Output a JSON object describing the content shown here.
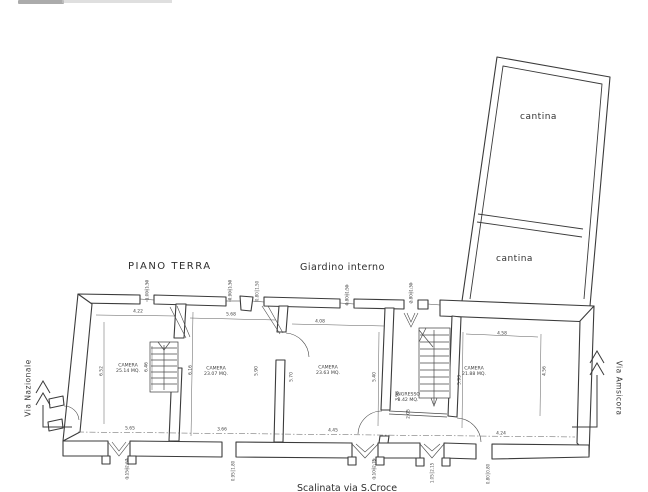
{
  "page": {
    "title": "PIANO TERRA",
    "garden_label": "Giardino interno",
    "left_street": "Via Nazionale",
    "right_street": "Via Amsicora",
    "bottom_street": "Scalinata via S.Croce"
  },
  "annex": {
    "rooms": [
      {
        "label": "cantina"
      },
      {
        "label": "cantina"
      }
    ]
  },
  "rooms": [
    {
      "name": "CAMERA",
      "area": "25.14 MQ."
    },
    {
      "name": "CAMERA",
      "area": "23.07 MQ."
    },
    {
      "name": "CAMERA",
      "area": "23.63 MQ."
    },
    {
      "name": "INGRESSO",
      "area": "8.42 MQ."
    },
    {
      "name": "CAMERA",
      "area": "21.88 MQ."
    }
  ],
  "dimensions": [
    {
      "v": "4.22",
      "x": 138,
      "y": 311,
      "r": 0
    },
    {
      "v": "5.68",
      "x": 231,
      "y": 314,
      "r": 0
    },
    {
      "v": "4.08",
      "x": 320,
      "y": 321,
      "r": 0
    },
    {
      "v": "4.58",
      "x": 502,
      "y": 333,
      "r": 0
    },
    {
      "v": "5.65",
      "x": 130,
      "y": 428,
      "r": 0
    },
    {
      "v": "3.66",
      "x": 222,
      "y": 429,
      "r": 0
    },
    {
      "v": "4.45",
      "x": 333,
      "y": 430,
      "r": 0
    },
    {
      "v": "4.24",
      "x": 501,
      "y": 433,
      "r": 0
    },
    {
      "v": "6.52",
      "x": 101,
      "y": 371,
      "r": -90
    },
    {
      "v": "6.46",
      "x": 146,
      "y": 367,
      "r": -90
    },
    {
      "v": "6.16",
      "x": 190,
      "y": 370,
      "r": -90
    },
    {
      "v": "5.90",
      "x": 256,
      "y": 371,
      "r": -90
    },
    {
      "v": "5.70",
      "x": 291,
      "y": 377,
      "r": -90
    },
    {
      "v": "5.40",
      "x": 374,
      "y": 377,
      "r": -90
    },
    {
      "v": "3.98",
      "x": 397,
      "y": 396,
      "r": -90
    },
    {
      "v": "2.05",
      "x": 408,
      "y": 414,
      "r": -90
    },
    {
      "v": "5.93",
      "x": 459,
      "y": 380,
      "r": -90
    },
    {
      "v": "4.56",
      "x": 544,
      "y": 371,
      "r": -90
    }
  ],
  "window_dims": [
    {
      "a": "1.00",
      "b": "1.50",
      "x": 147,
      "y": 290
    },
    {
      "a": "0.90",
      "b": "1.50",
      "x": 230,
      "y": 290
    },
    {
      "a": "0.80",
      "b": "1.50",
      "x": 257,
      "y": 291
    },
    {
      "a": "0.80",
      "b": "1.50",
      "x": 347,
      "y": 295
    },
    {
      "a": "2.80",
      "b": "1.30",
      "x": 411,
      "y": 293
    },
    {
      "a": "1.15",
      "b": "2.67",
      "x": 127,
      "y": 469
    },
    {
      "a": "0.95",
      "b": "1.80",
      "x": 233,
      "y": 471
    },
    {
      "a": "1.10",
      "b": "2.75",
      "x": 374,
      "y": 469
    },
    {
      "a": "1.05",
      "b": "2.15",
      "x": 432,
      "y": 473
    },
    {
      "a": "0.80",
      "b": "0.80",
      "x": 488,
      "y": 474
    }
  ],
  "colors": {
    "ink": "#3b3b3b",
    "paper": "#ffffff"
  }
}
